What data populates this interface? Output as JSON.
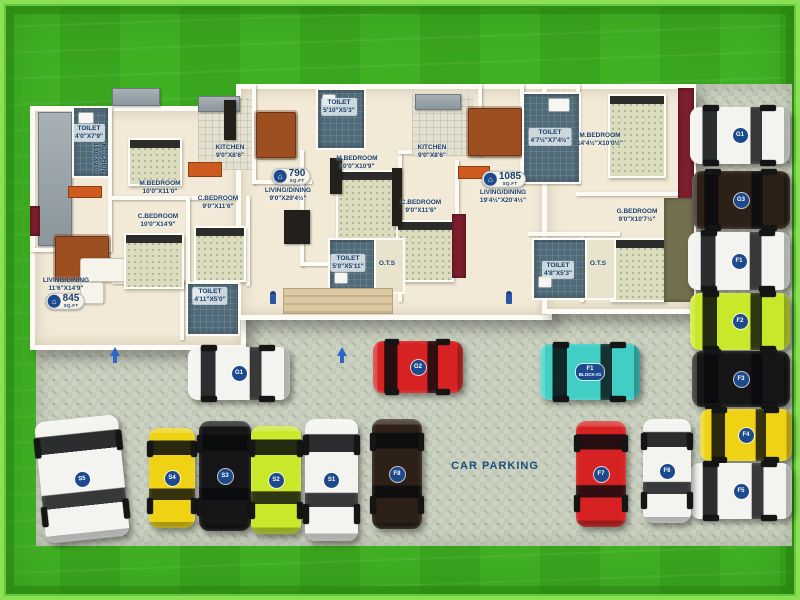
{
  "scene": {
    "width": 800,
    "height": 600
  },
  "parking": {
    "label": "CAR PARKING",
    "label_pos": {
      "x": 495,
      "y": 466
    },
    "areas": [
      {
        "x": 36,
        "y": 302,
        "w": 756,
        "h": 244
      },
      {
        "x": 686,
        "y": 84,
        "w": 106,
        "h": 222
      }
    ],
    "cars": [
      {
        "id": "S5",
        "color": "white",
        "x": 40,
        "y": 418,
        "w": 84,
        "h": 122,
        "orient": "v",
        "rot": -6
      },
      {
        "id": "S4",
        "color": "yellow",
        "x": 149,
        "y": 428,
        "w": 46,
        "h": 100,
        "orient": "v"
      },
      {
        "id": "S3",
        "color": "black",
        "x": 199,
        "y": 421,
        "w": 52,
        "h": 110,
        "orient": "v"
      },
      {
        "id": "S2",
        "color": "lime",
        "x": 251,
        "y": 426,
        "w": 50,
        "h": 108,
        "orient": "v"
      },
      {
        "id": "S1",
        "color": "white",
        "x": 305,
        "y": 419,
        "w": 53,
        "h": 122,
        "orient": "v"
      },
      {
        "id": "F8",
        "color": "brown",
        "x": 372,
        "y": 419,
        "w": 50,
        "h": 110,
        "orient": "v"
      },
      {
        "id": "G1",
        "color": "white",
        "x": 188,
        "y": 347,
        "w": 102,
        "h": 53,
        "orient": "h"
      },
      {
        "id": "G2",
        "color": "red",
        "x": 373,
        "y": 341,
        "w": 90,
        "h": 52,
        "orient": "h"
      },
      {
        "id": "F1",
        "sub": "BLOCK-01",
        "color": "teal",
        "x": 540,
        "y": 344,
        "w": 100,
        "h": 56,
        "orient": "h"
      },
      {
        "id": "G1",
        "color": "white",
        "x": 690,
        "y": 107,
        "w": 100,
        "h": 57,
        "orient": "h"
      },
      {
        "id": "G3",
        "color": "brown",
        "x": 692,
        "y": 171,
        "w": 98,
        "h": 58,
        "orient": "h"
      },
      {
        "id": "F1",
        "color": "white",
        "x": 688,
        "y": 232,
        "w": 102,
        "h": 58,
        "orient": "h"
      },
      {
        "id": "F2",
        "color": "lime",
        "x": 690,
        "y": 293,
        "w": 100,
        "h": 57,
        "orient": "h"
      },
      {
        "id": "F3",
        "color": "black",
        "x": 692,
        "y": 351,
        "w": 98,
        "h": 56,
        "orient": "h"
      },
      {
        "id": "F4",
        "color": "yellow",
        "x": 700,
        "y": 409,
        "w": 92,
        "h": 52,
        "orient": "h"
      },
      {
        "id": "F5",
        "color": "white",
        "x": 690,
        "y": 463,
        "w": 102,
        "h": 56,
        "orient": "h"
      },
      {
        "id": "F7",
        "color": "red",
        "x": 576,
        "y": 421,
        "w": 50,
        "h": 106,
        "orient": "v"
      },
      {
        "id": "F6",
        "color": "white",
        "x": 643,
        "y": 419,
        "w": 48,
        "h": 104,
        "orient": "v"
      }
    ]
  },
  "floorplan": {
    "badges": [
      {
        "value": "845",
        "unit": "SQ.FT",
        "x": 65,
        "y": 301
      },
      {
        "value": "790",
        "unit": "SQ.FT",
        "x": 291,
        "y": 176
      },
      {
        "value": "1085",
        "unit": "SQ.FT",
        "x": 504,
        "y": 179
      }
    ],
    "room_labels": [
      {
        "label": "KITCHEN",
        "dims": "11'0\"X9'0\"",
        "x": 99,
        "y": 158,
        "vert": true
      },
      {
        "label": "TOILET",
        "dims": "4'0\"X7'9\"",
        "x": 89,
        "y": 133,
        "chip": true
      },
      {
        "label": "M.BEDROOM",
        "dims": "10'0\"X11'0\"",
        "x": 160,
        "y": 188
      },
      {
        "label": "C.BEDROOM",
        "dims": "10'0\"X14'9\"",
        "x": 158,
        "y": 221
      },
      {
        "label": "LIVING/DINING",
        "dims": "11'6\"X14'9\"",
        "x": 66,
        "y": 285
      },
      {
        "label": "TOILET",
        "dims": "4'11\"X5'0\"",
        "x": 210,
        "y": 296,
        "chip": true
      },
      {
        "label": "C.BEDROOM",
        "dims": "9'0\"X11'6\"",
        "x": 218,
        "y": 203
      },
      {
        "label": "KITCHEN",
        "dims": "9'0\"X8'6\"",
        "x": 230,
        "y": 152
      },
      {
        "label": "TOILET",
        "dims": "5'10\"X5'3\"",
        "x": 339,
        "y": 107,
        "chip": true
      },
      {
        "label": "M.BEDROOM",
        "dims": "10'0\"X10'9\"",
        "x": 357,
        "y": 163
      },
      {
        "label": "LIVING/DINING",
        "dims": "9'0\"X29'4½\"",
        "x": 288,
        "y": 195
      },
      {
        "label": "TOILET",
        "dims": "5'0\"X5'11\"",
        "x": 348,
        "y": 263,
        "chip": true
      },
      {
        "label": "O.T.S",
        "dims": "",
        "x": 387,
        "y": 264
      },
      {
        "label": "KITCHEN",
        "dims": "9'0\"X8'6\"",
        "x": 432,
        "y": 152
      },
      {
        "label": "C.BEDROOM",
        "dims": "9'0\"X11'6\"",
        "x": 421,
        "y": 207
      },
      {
        "label": "TOILET",
        "dims": "4'7½\"X7'4½\"",
        "x": 550,
        "y": 137,
        "chip": true
      },
      {
        "label": "LIVING/DINING",
        "dims": "19'4½\"X20'4½\"",
        "x": 503,
        "y": 197
      },
      {
        "label": "M.BEDROOM",
        "dims": "14'4½\"X10'0½\"",
        "x": 600,
        "y": 140
      },
      {
        "label": "G.BEDROOM",
        "dims": "9'0\"X10'7½\"",
        "x": 637,
        "y": 216
      },
      {
        "label": "TOILET",
        "dims": "4'8\"X5'3\"",
        "x": 558,
        "y": 270,
        "chip": true
      },
      {
        "label": "O.T.S",
        "dims": "",
        "x": 598,
        "y": 264
      }
    ],
    "walls": [
      {
        "x": 108,
        "y": 106,
        "w": 4,
        "h": 142
      },
      {
        "x": 30,
        "y": 248,
        "w": 82,
        "h": 4
      },
      {
        "x": 112,
        "y": 196,
        "w": 124,
        "h": 4
      },
      {
        "x": 180,
        "y": 280,
        "w": 4,
        "h": 60
      },
      {
        "x": 112,
        "y": 280,
        "w": 72,
        "h": 4
      },
      {
        "x": 252,
        "y": 84,
        "w": 4,
        "h": 100
      },
      {
        "x": 252,
        "y": 180,
        "w": 60,
        "h": 4
      },
      {
        "x": 300,
        "y": 150,
        "w": 4,
        "h": 116
      },
      {
        "x": 300,
        "y": 262,
        "w": 102,
        "h": 4
      },
      {
        "x": 186,
        "y": 196,
        "w": 4,
        "h": 90
      },
      {
        "x": 246,
        "y": 196,
        "w": 4,
        "h": 90
      },
      {
        "x": 398,
        "y": 150,
        "w": 4,
        "h": 152
      },
      {
        "x": 398,
        "y": 150,
        "w": 80,
        "h": 4
      },
      {
        "x": 455,
        "y": 160,
        "w": 4,
        "h": 56
      },
      {
        "x": 478,
        "y": 84,
        "w": 4,
        "h": 72
      },
      {
        "x": 520,
        "y": 84,
        "w": 4,
        "h": 100
      },
      {
        "x": 520,
        "y": 180,
        "w": 60,
        "h": 4
      },
      {
        "x": 576,
        "y": 84,
        "w": 4,
        "h": 100
      },
      {
        "x": 576,
        "y": 192,
        "w": 110,
        "h": 4
      },
      {
        "x": 580,
        "y": 236,
        "w": 4,
        "h": 66
      },
      {
        "x": 528,
        "y": 232,
        "w": 92,
        "h": 4
      }
    ],
    "furniture": [
      {
        "type": "counter",
        "x": 38,
        "y": 112,
        "w": 32,
        "h": 132
      },
      {
        "type": "counter",
        "x": 112,
        "y": 88,
        "w": 46,
        "h": 16
      },
      {
        "type": "tiles",
        "x": 198,
        "y": 98,
        "w": 54,
        "h": 72
      },
      {
        "type": "counter",
        "x": 198,
        "y": 96,
        "w": 40,
        "h": 14
      },
      {
        "type": "orange",
        "x": 188,
        "y": 162,
        "w": 32,
        "h": 13
      },
      {
        "type": "tiles",
        "x": 412,
        "y": 94,
        "w": 62,
        "h": 62
      },
      {
        "type": "counter",
        "x": 415,
        "y": 94,
        "w": 44,
        "h": 14
      },
      {
        "type": "orange",
        "x": 458,
        "y": 166,
        "w": 30,
        "h": 11
      },
      {
        "type": "orange",
        "x": 68,
        "y": 186,
        "w": 32,
        "h": 10
      },
      {
        "type": "table",
        "x": 55,
        "y": 236,
        "w": 52,
        "h": 42
      },
      {
        "type": "table",
        "x": 256,
        "y": 112,
        "w": 38,
        "h": 44
      },
      {
        "type": "table",
        "x": 468,
        "y": 108,
        "w": 52,
        "h": 46
      },
      {
        "type": "sofa",
        "x": 80,
        "y": 258,
        "w": 76,
        "h": 22
      },
      {
        "type": "sofa",
        "x": 80,
        "y": 282,
        "w": 22,
        "h": 20
      },
      {
        "type": "bed",
        "x": 128,
        "y": 138,
        "w": 50,
        "h": 44
      },
      {
        "type": "bed",
        "x": 124,
        "y": 233,
        "w": 56,
        "h": 52
      },
      {
        "type": "bed",
        "x": 194,
        "y": 226,
        "w": 48,
        "h": 52
      },
      {
        "type": "bed",
        "x": 336,
        "y": 170,
        "w": 58,
        "h": 72
      },
      {
        "type": "bed",
        "x": 396,
        "y": 220,
        "w": 54,
        "h": 58
      },
      {
        "type": "bed-v",
        "x": 608,
        "y": 94,
        "w": 54,
        "h": 80
      },
      {
        "type": "bed",
        "x": 610,
        "y": 238,
        "w": 52,
        "h": 60
      },
      {
        "type": "maroon",
        "x": 678,
        "y": 88,
        "w": 16,
        "h": 200
      },
      {
        "type": "olive",
        "x": 664,
        "y": 198,
        "w": 30,
        "h": 104
      },
      {
        "type": "maroon",
        "x": 452,
        "y": 214,
        "w": 14,
        "h": 64
      },
      {
        "type": "maroon",
        "x": 30,
        "y": 206,
        "w": 10,
        "h": 30
      },
      {
        "type": "dark",
        "x": 224,
        "y": 100,
        "w": 12,
        "h": 40
      },
      {
        "type": "dark",
        "x": 392,
        "y": 168,
        "w": 10,
        "h": 58
      },
      {
        "type": "dark",
        "x": 284,
        "y": 210,
        "w": 26,
        "h": 34
      },
      {
        "type": "dark",
        "x": 330,
        "y": 158,
        "w": 12,
        "h": 36
      },
      {
        "type": "toilet",
        "x": 72,
        "y": 106,
        "w": 34,
        "h": 68
      },
      {
        "type": "toilet",
        "x": 186,
        "y": 282,
        "w": 50,
        "h": 50
      },
      {
        "type": "toilet",
        "x": 316,
        "y": 88,
        "w": 46,
        "h": 58
      },
      {
        "type": "toilet",
        "x": 328,
        "y": 238,
        "w": 45,
        "h": 52
      },
      {
        "type": "toilet",
        "x": 522,
        "y": 92,
        "w": 55,
        "h": 88
      },
      {
        "type": "toilet",
        "x": 532,
        "y": 238,
        "w": 52,
        "h": 58
      },
      {
        "type": "ots",
        "x": 374,
        "y": 238,
        "w": 27,
        "h": 52
      },
      {
        "type": "ots",
        "x": 585,
        "y": 238,
        "w": 27,
        "h": 58
      },
      {
        "type": "steps",
        "x": 283,
        "y": 288,
        "w": 108,
        "h": 24
      },
      {
        "type": "fixture",
        "x": 78,
        "y": 112,
        "w": 14,
        "h": 10
      },
      {
        "type": "fixture",
        "x": 192,
        "y": 288,
        "w": 12,
        "h": 10
      },
      {
        "type": "fixture",
        "x": 322,
        "y": 94,
        "w": 12,
        "h": 10
      },
      {
        "type": "fixture",
        "x": 334,
        "y": 272,
        "w": 12,
        "h": 10
      },
      {
        "type": "fixture",
        "x": 548,
        "y": 98,
        "w": 20,
        "h": 12
      },
      {
        "type": "fixture",
        "x": 538,
        "y": 276,
        "w": 12,
        "h": 10
      }
    ],
    "markers": [
      {
        "type": "arrow-up",
        "x": 110,
        "y": 342
      },
      {
        "type": "arrow-up",
        "x": 337,
        "y": 342
      },
      {
        "type": "person",
        "x": 270,
        "y": 291
      },
      {
        "type": "person",
        "x": 506,
        "y": 291
      }
    ]
  },
  "palette": {
    "navy": "#1a3f6d",
    "badge_navy": "#1d4a8c",
    "lawn": "#3dad22",
    "parking": "#ccd2c2",
    "floor": "#f2ead7",
    "wall": "#fcfbf5",
    "toilet": "#506b79",
    "maroon": "#7c1f2d",
    "cars": {
      "white": "#f3f3f0",
      "yellow": "#eed213",
      "black": "#161616",
      "lime": "#c9e829",
      "brown": "#2d2117",
      "red": "#d62222",
      "teal": "#41cfc5"
    }
  }
}
